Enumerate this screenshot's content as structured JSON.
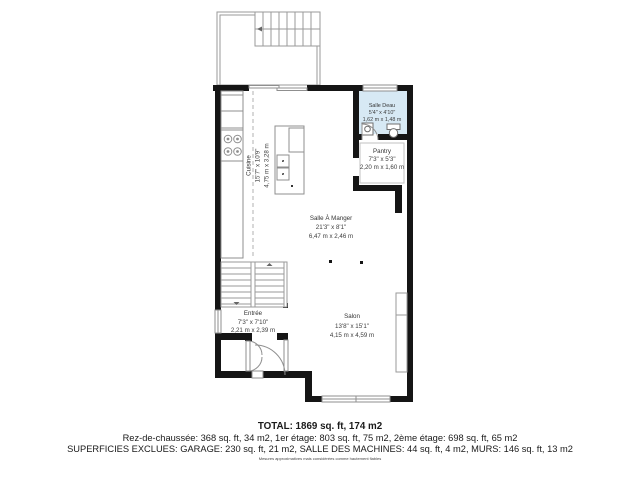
{
  "plan": {
    "title": "floor-plan-rez-de-chaussee",
    "rooms": [
      {
        "name": "Cuisine",
        "dim_ft": "15'7\" x 10'9\"",
        "dim_m": "4,75 m x 3,28 m"
      },
      {
        "name": "Salle Deau",
        "dim_ft": "5'4\" x 4'10\"",
        "dim_m": "1,62 m x 1,48 m"
      },
      {
        "name": "Pantry",
        "dim_ft": "7'3\" x 5'3\"",
        "dim_m": "2,20 m x 1,60 m"
      },
      {
        "name": "Salle À Manger",
        "dim_ft": "21'3\" x 8'1\"",
        "dim_m": "6,47 m x 2,46 m"
      },
      {
        "name": "Entrée",
        "dim_ft": "7'3\" x 7'10\"",
        "dim_m": "2,21 m x 2,39 m"
      },
      {
        "name": "Salon",
        "dim_ft": "13'8\" x 15'1\"",
        "dim_m": "4,15 m x 4,59 m"
      }
    ],
    "colors": {
      "wall": "#151515",
      "thin_line": "#8f8f8f",
      "bathroom_fill": "#d7e9f4",
      "label_text": "#3d3d3d"
    }
  },
  "footer": {
    "total": "TOTAL: 1869 sq. ft, 174 m2",
    "floors": "Rez-de-chaussée: 368 sq. ft, 34 m2, 1er étage: 803 sq. ft, 75 m2, 2ème étage: 698 sq. ft, 65 m2",
    "excluded": "SUPERFICIES EXCLUES: GARAGE: 230 sq. ft, 21 m2, SALLE DES MACHINES: 44 sq. ft, 4 m2, MURS: 146 sq. ft, 13 m2",
    "disclaimer": "Mesures approximatives mais considérées comme hautement fiables"
  }
}
